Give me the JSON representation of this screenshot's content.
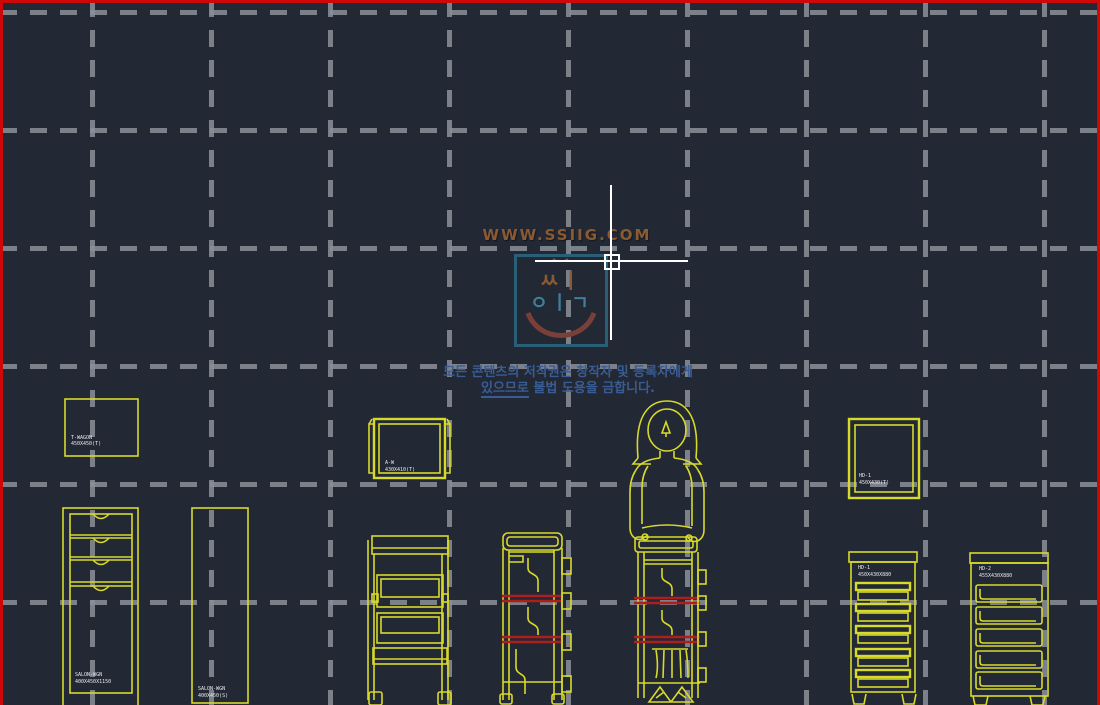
{
  "app": {
    "description": "CAD drawing viewport with salon trolley furniture blocks",
    "colors": {
      "background": "#222834",
      "viewport_border": "#cc0808",
      "grid_dash": "#8b8f98",
      "drawing_yellow": "#d8da2a",
      "accent_red": "#b01d1d",
      "label_white": "#e9e9e9",
      "watermark_brown": "#8a5a32",
      "logo_teal_border": "#2a5f78",
      "logo_teal_glyph": "#3f7f99",
      "logo_smile_red": "#7a4038",
      "copyright_blue": "#3a5c94",
      "crosshair_white": "#ffffff"
    }
  },
  "grid": {
    "vertical_x": [
      92,
      211,
      330,
      449,
      568,
      687,
      806,
      925,
      1044
    ],
    "horizontal_y": [
      12,
      130,
      248,
      366,
      484,
      602
    ]
  },
  "watermark": {
    "url_text": "WWW.SSIIG.COM",
    "logo": {
      "carets": "^  ^",
      "row1": "ㅆㅣ",
      "row2": "ㅇㅣㄱ"
    },
    "copyright_line1": "모든 콘텐츠의 저작권은 창작자 및 등록자에게",
    "copyright_line2_underlined": "있으므로",
    "copyright_line2_rest": " 불법 도용을 금합니다."
  },
  "items": {
    "rect_top_left": {
      "line1": "T-WAGON",
      "line2": "450X450(T)"
    },
    "cabinet_left": {
      "line1": "SALON-WGN",
      "line2": "400X450X1150"
    },
    "rect_tall": {
      "line1": "SALON-WGN",
      "line2": "400X450(S)"
    },
    "topview_mid": {
      "line1": "A-W",
      "line2": "430X410(T)"
    },
    "topview_right": {
      "line1": "HD-1",
      "line2": "450X430(T)"
    },
    "cabinet_right_a": {
      "line1": "HD-1",
      "line2": "450X430X880"
    },
    "cabinet_right_b": {
      "line1": "HD-2",
      "line2": "455X430X880"
    }
  }
}
